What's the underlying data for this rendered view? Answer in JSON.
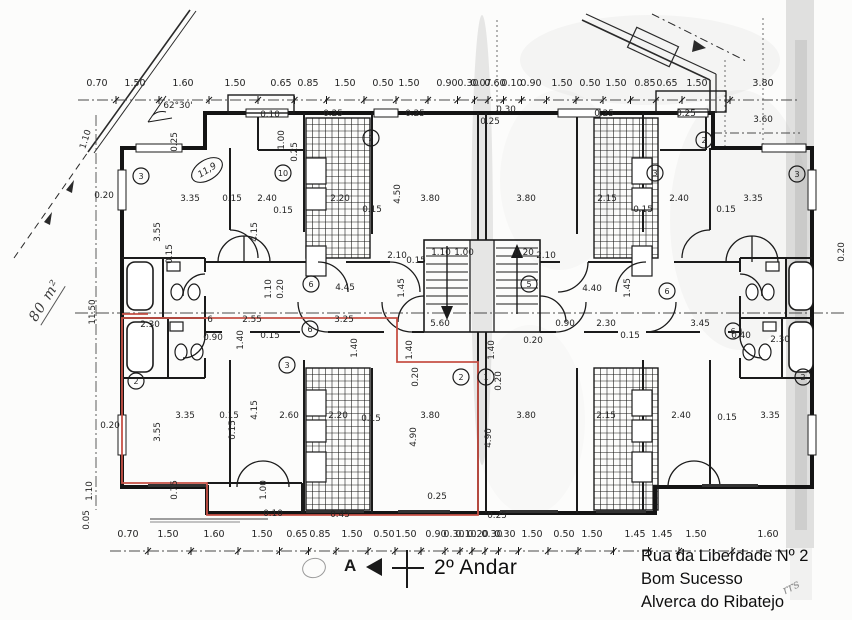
{
  "meta": {
    "title": "2º Andar",
    "address_lines": [
      "Rua da Liberdade Nº 2",
      "Bom Sucesso",
      "Alverca do Ribatejo"
    ],
    "area_note": "80 m²",
    "angle_note": "62°30'",
    "section_marker": "A",
    "handwritten_mark": "rrs"
  },
  "colors": {
    "highlight_red": "#c65045",
    "ink": "#1b1b1b",
    "paper": "#fcfcfb",
    "smudge": "#909090"
  },
  "dim_chains": {
    "top": {
      "y_text": 86,
      "y_line": 100,
      "labels": [
        {
          "t": "0.70",
          "x": 97
        },
        {
          "t": "1.50",
          "x": 135
        },
        {
          "t": "1.60",
          "x": 183
        },
        {
          "t": "1.50",
          "x": 235
        },
        {
          "t": "0.65",
          "x": 281
        },
        {
          "t": "0.85",
          "x": 308
        },
        {
          "t": "1.50",
          "x": 345
        },
        {
          "t": "0.50",
          "x": 383
        },
        {
          "t": "1.50",
          "x": 409
        },
        {
          "t": "0.90",
          "x": 447
        },
        {
          "t": "0.30",
          "x": 468
        },
        {
          "t": "0.07",
          "x": 481
        },
        {
          "t": "0.60",
          "x": 495
        },
        {
          "t": "0.10",
          "x": 512
        },
        {
          "t": "0.90",
          "x": 531
        },
        {
          "t": "1.50",
          "x": 562
        },
        {
          "t": "0.50",
          "x": 590
        },
        {
          "t": "1.50",
          "x": 616
        },
        {
          "t": "0.85",
          "x": 645
        },
        {
          "t": "0.65",
          "x": 667
        },
        {
          "t": "1.50",
          "x": 697
        },
        {
          "t": "3.80",
          "x": 763
        }
      ]
    },
    "bottom": {
      "y_text": 537,
      "y_line": 551,
      "labels": [
        {
          "t": "0.70",
          "x": 128
        },
        {
          "t": "1.50",
          "x": 168
        },
        {
          "t": "1.60",
          "x": 214
        },
        {
          "t": "1.50",
          "x": 262
        },
        {
          "t": "0.65",
          "x": 297
        },
        {
          "t": "0.85",
          "x": 320
        },
        {
          "t": "1.50",
          "x": 352
        },
        {
          "t": "0.50",
          "x": 384
        },
        {
          "t": "1.50",
          "x": 406
        },
        {
          "t": "0.90",
          "x": 436
        },
        {
          "t": "0.30",
          "x": 454
        },
        {
          "t": "0.10",
          "x": 466
        },
        {
          "t": "0.20",
          "x": 478
        },
        {
          "t": "0.30",
          "x": 492
        },
        {
          "t": "0.30",
          "x": 505
        },
        {
          "t": "1.50",
          "x": 532
        },
        {
          "t": "0.50",
          "x": 564
        },
        {
          "t": "1.50",
          "x": 592
        },
        {
          "t": "1.45",
          "x": 635
        },
        {
          "t": "1.45",
          "x": 662
        },
        {
          "t": "1.50",
          "x": 696
        },
        {
          "t": "1.60",
          "x": 768
        }
      ]
    }
  },
  "free_labels": [
    {
      "t": "1.10",
      "x": 88,
      "y": 140,
      "r": -72
    },
    {
      "t": "62°30'",
      "x": 178,
      "y": 108
    },
    {
      "t": "0.20",
      "x": 104,
      "y": 198
    },
    {
      "t": "11.50",
      "x": 95,
      "y": 312,
      "r": -90
    },
    {
      "t": "1.10",
      "x": 92,
      "y": 491,
      "r": -90
    },
    {
      "t": "0.05",
      "x": 89,
      "y": 520,
      "r": -90
    },
    {
      "t": "0.20",
      "x": 110,
      "y": 428
    },
    {
      "t": "0.25",
      "x": 177,
      "y": 142,
      "r": -90
    },
    {
      "t": "3.35",
      "x": 190,
      "y": 201
    },
    {
      "t": "0.15",
      "x": 232,
      "y": 201
    },
    {
      "t": "2.40",
      "x": 267,
      "y": 201
    },
    {
      "t": "0.15",
      "x": 283,
      "y": 213
    },
    {
      "t": "0.10",
      "x": 270,
      "y": 117
    },
    {
      "t": "1.00",
      "x": 284,
      "y": 140,
      "r": -90
    },
    {
      "t": "0.25",
      "x": 297,
      "y": 152,
      "r": -90
    },
    {
      "t": "0.25",
      "x": 333,
      "y": 116
    },
    {
      "t": "0.25",
      "x": 415,
      "y": 116
    },
    {
      "t": "2.20",
      "x": 340,
      "y": 201
    },
    {
      "t": "0.15",
      "x": 372,
      "y": 212
    },
    {
      "t": "4.50",
      "x": 400,
      "y": 194,
      "r": -90
    },
    {
      "t": "3.80",
      "x": 430,
      "y": 201
    },
    {
      "t": "3.55",
      "x": 160,
      "y": 232,
      "r": -90
    },
    {
      "t": "0.15",
      "x": 172,
      "y": 254,
      "r": -90
    },
    {
      "t": "4.15",
      "x": 257,
      "y": 232,
      "r": -90
    },
    {
      "t": "1.10",
      "x": 271,
      "y": 289,
      "r": -90
    },
    {
      "t": "0.20",
      "x": 283,
      "y": 289,
      "r": -90
    },
    {
      "t": "2.10",
      "x": 397,
      "y": 258
    },
    {
      "t": "0.15",
      "x": 416,
      "y": 263
    },
    {
      "t": "1.10",
      "x": 441,
      "y": 255
    },
    {
      "t": "1.00",
      "x": 464,
      "y": 255
    },
    {
      "t": "0.20",
      "x": 524,
      "y": 255
    },
    {
      "t": "2.10",
      "x": 546,
      "y": 258
    },
    {
      "t": "4.45",
      "x": 345,
      "y": 290
    },
    {
      "t": "1.45",
      "x": 404,
      "y": 288,
      "r": -90
    },
    {
      "t": "4.40",
      "x": 592,
      "y": 291
    },
    {
      "t": "1.45",
      "x": 630,
      "y": 288,
      "r": -90
    },
    {
      "t": "2.30",
      "x": 150,
      "y": 327
    },
    {
      "t": "6",
      "x": 210,
      "y": 322
    },
    {
      "t": "2.55",
      "x": 252,
      "y": 322
    },
    {
      "t": "0.90",
      "x": 213,
      "y": 340
    },
    {
      "t": "1.40",
      "x": 243,
      "y": 340,
      "r": -90
    },
    {
      "t": "0.15",
      "x": 270,
      "y": 338
    },
    {
      "t": "3.25",
      "x": 344,
      "y": 322
    },
    {
      "t": "1.40",
      "x": 357,
      "y": 348,
      "r": -90
    },
    {
      "t": "5.60",
      "x": 440,
      "y": 326
    },
    {
      "t": "1.40",
      "x": 412,
      "y": 350,
      "r": -90
    },
    {
      "t": "1.40",
      "x": 494,
      "y": 350,
      "r": -90
    },
    {
      "t": "0.20",
      "x": 533,
      "y": 343
    },
    {
      "t": "0.90",
      "x": 565,
      "y": 326
    },
    {
      "t": "2.30",
      "x": 606,
      "y": 326
    },
    {
      "t": "0.15",
      "x": 630,
      "y": 338
    },
    {
      "t": "3.45",
      "x": 700,
      "y": 326
    },
    {
      "t": "0.40",
      "x": 741,
      "y": 338
    },
    {
      "t": "2.30",
      "x": 780,
      "y": 342
    },
    {
      "t": "0.20",
      "x": 844,
      "y": 252,
      "r": -90
    },
    {
      "t": "0.30",
      "x": 506,
      "y": 112
    },
    {
      "t": "0.25",
      "x": 490,
      "y": 124
    },
    {
      "t": "3.60",
      "x": 763,
      "y": 122
    },
    {
      "t": "3.80",
      "x": 526,
      "y": 201
    },
    {
      "t": "2.15",
      "x": 607,
      "y": 201
    },
    {
      "t": "0.15",
      "x": 643,
      "y": 212
    },
    {
      "t": "2.40",
      "x": 679,
      "y": 201
    },
    {
      "t": "0.15",
      "x": 726,
      "y": 212
    },
    {
      "t": "3.35",
      "x": 753,
      "y": 201
    },
    {
      "t": "0.25",
      "x": 604,
      "y": 116
    },
    {
      "t": "0.25",
      "x": 686,
      "y": 116
    },
    {
      "t": "3.35",
      "x": 185,
      "y": 418
    },
    {
      "t": "0.15",
      "x": 229,
      "y": 418
    },
    {
      "t": "2.60",
      "x": 289,
      "y": 418
    },
    {
      "t": "2.20",
      "x": 338,
      "y": 418
    },
    {
      "t": "0.15",
      "x": 371,
      "y": 421
    },
    {
      "t": "3.55",
      "x": 160,
      "y": 432,
      "r": -90
    },
    {
      "t": "4.15",
      "x": 257,
      "y": 410,
      "r": -90
    },
    {
      "t": "0.15",
      "x": 235,
      "y": 430,
      "r": -90
    },
    {
      "t": "4.90",
      "x": 416,
      "y": 437,
      "r": -90
    },
    {
      "t": "3.80",
      "x": 430,
      "y": 418
    },
    {
      "t": "0.20",
      "x": 418,
      "y": 377,
      "r": -90
    },
    {
      "t": "0.20",
      "x": 501,
      "y": 381,
      "r": -90
    },
    {
      "t": "0.75",
      "x": 177,
      "y": 490,
      "r": -90
    },
    {
      "t": "1.00",
      "x": 266,
      "y": 490,
      "r": -90
    },
    {
      "t": "0.10",
      "x": 273,
      "y": 516
    },
    {
      "t": "0.45",
      "x": 340,
      "y": 517
    },
    {
      "t": "0.25",
      "x": 437,
      "y": 499
    },
    {
      "t": "0.25",
      "x": 497,
      "y": 518
    },
    {
      "t": "3.80",
      "x": 526,
      "y": 418
    },
    {
      "t": "2.15",
      "x": 606,
      "y": 418
    },
    {
      "t": "2.40",
      "x": 681,
      "y": 418
    },
    {
      "t": "0.15",
      "x": 727,
      "y": 420
    },
    {
      "t": "3.35",
      "x": 770,
      "y": 418
    },
    {
      "t": "4.90",
      "x": 491,
      "y": 438,
      "r": -90
    }
  ],
  "room_numbers": [
    {
      "n": "3",
      "x": 141,
      "y": 176
    },
    {
      "n": "10",
      "x": 283,
      "y": 173
    },
    {
      "n": "2",
      "x": 371,
      "y": 138
    },
    {
      "n": "3",
      "x": 655,
      "y": 173
    },
    {
      "n": "2",
      "x": 704,
      "y": 140
    },
    {
      "n": "3",
      "x": 797,
      "y": 174
    },
    {
      "n": "6",
      "x": 311,
      "y": 284
    },
    {
      "n": "5",
      "x": 529,
      "y": 284
    },
    {
      "n": "6",
      "x": 667,
      "y": 291
    },
    {
      "n": "2",
      "x": 136,
      "y": 381
    },
    {
      "n": "3",
      "x": 287,
      "y": 365
    },
    {
      "n": "6",
      "x": 310,
      "y": 329
    },
    {
      "n": "2",
      "x": 461,
      "y": 377
    },
    {
      "n": "1",
      "x": 486,
      "y": 377
    },
    {
      "n": "6",
      "x": 733,
      "y": 331
    },
    {
      "n": "2",
      "x": 803,
      "y": 377
    }
  ],
  "oval_label": {
    "t": "11,9",
    "x": 207,
    "y": 170,
    "r": -32
  }
}
